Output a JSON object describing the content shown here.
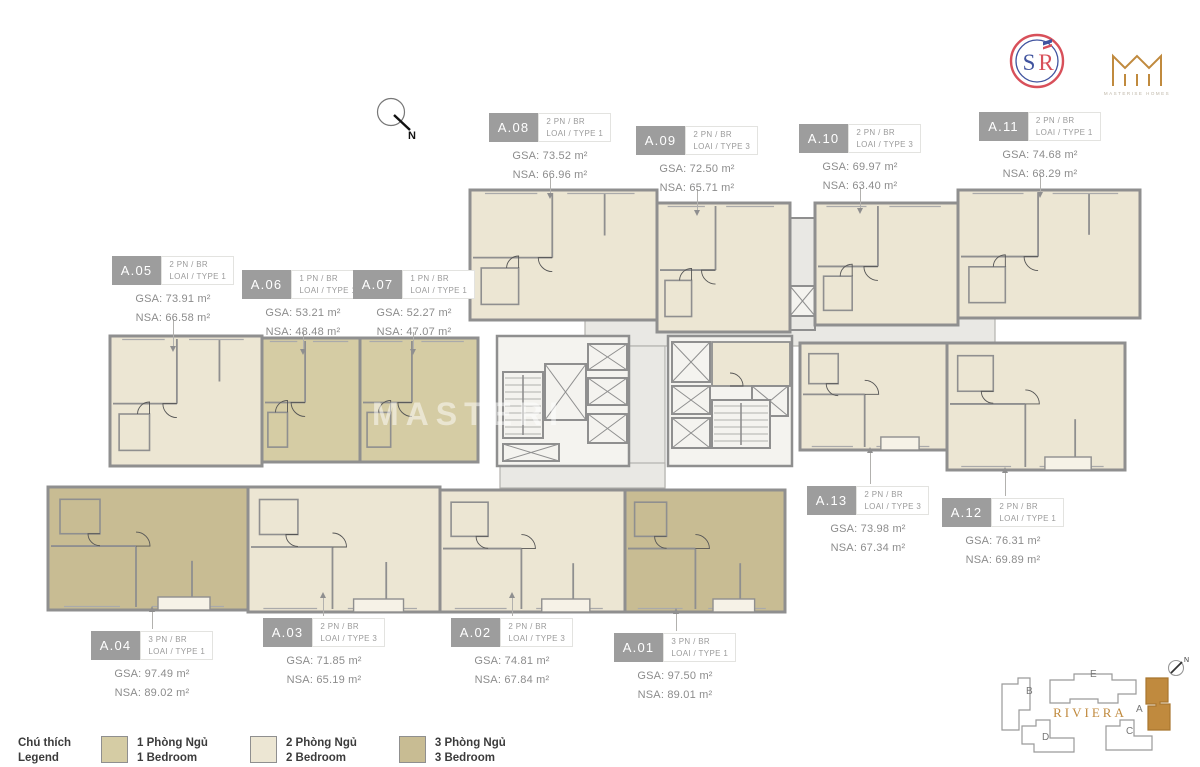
{
  "colors": {
    "bedroom1": "#d5cca4",
    "bedroom2": "#ece6d3",
    "bedroom3": "#c8bc93",
    "wall": "#8f8f8f",
    "wall_light": "#b3b2ae",
    "corridor": "#e9e8e4",
    "core": "#f4f3ef",
    "balcony": "#f6f2e7",
    "badge": "#9d9d9d",
    "label_text": "#8c8c8c",
    "legend_text": "#3c3c3c",
    "accent_gold": "#c08a3e",
    "logo_red": "#d8505a",
    "logo_blue": "#41549f"
  },
  "compass": {
    "label": "N"
  },
  "watermark": {
    "line1": "MASTERI"
  },
  "logos": {
    "sr_s": "S",
    "sr_r": "R",
    "masterise_caption": "MASTERISE HOMES"
  },
  "legend": {
    "title_line1": "Chú thích",
    "title_line2": "Legend",
    "items": [
      {
        "line1": "1 Phòng Ngủ",
        "line2": "1 Bedroom",
        "color_key": "bedroom1"
      },
      {
        "line1": "2 Phòng Ngủ",
        "line2": "2 Bedroom",
        "color_key": "bedroom2"
      },
      {
        "line1": "3 Phòng Ngủ",
        "line2": "3 Bedroom",
        "color_key": "bedroom3"
      }
    ]
  },
  "minimap": {
    "project_name": "RIVIERA",
    "compass_label": "N",
    "highlighted_building": "A",
    "buildings": [
      {
        "label": "A"
      },
      {
        "label": "B"
      },
      {
        "label": "C"
      },
      {
        "label": "D"
      },
      {
        "label": "E"
      }
    ]
  },
  "units": [
    {
      "id": "A.01",
      "type_line1": "3 PN / BR",
      "type_line2": "LOAI / TYPE 1",
      "gsa": "GSA: 97.50 m²",
      "nsa": "NSA: 89.01 m²"
    },
    {
      "id": "A.02",
      "type_line1": "2 PN / BR",
      "type_line2": "LOAI / TYPE 3",
      "gsa": "GSA: 74.81 m²",
      "nsa": "NSA: 67.84 m²"
    },
    {
      "id": "A.03",
      "type_line1": "2 PN / BR",
      "type_line2": "LOAI / TYPE 3",
      "gsa": "GSA: 71.85 m²",
      "nsa": "NSA: 65.19 m²"
    },
    {
      "id": "A.04",
      "type_line1": "3 PN / BR",
      "type_line2": "LOAI / TYPE 1",
      "gsa": "GSA: 97.49 m²",
      "nsa": "NSA: 89.02 m²"
    },
    {
      "id": "A.05",
      "type_line1": "2 PN / BR",
      "type_line2": "LOAI / TYPE 1",
      "gsa": "GSA: 73.91 m²",
      "nsa": "NSA: 66.58 m²"
    },
    {
      "id": "A.06",
      "type_line1": "1 PN / BR",
      "type_line2": "LOAI / TYPE 1",
      "gsa": "GSA: 53.21 m²",
      "nsa": "NSA: 48.48 m²"
    },
    {
      "id": "A.07",
      "type_line1": "1 PN / BR",
      "type_line2": "LOAI / TYPE 1",
      "gsa": "GSA: 52.27 m²",
      "nsa": "NSA: 47.07 m²"
    },
    {
      "id": "A.08",
      "type_line1": "2 PN / BR",
      "type_line2": "LOAI / TYPE 1",
      "gsa": "GSA: 73.52 m²",
      "nsa": "NSA: 66.96 m²"
    },
    {
      "id": "A.09",
      "type_line1": "2 PN / BR",
      "type_line2": "LOAI / TYPE 3",
      "gsa": "GSA: 72.50 m²",
      "nsa": "NSA: 65.71 m²"
    },
    {
      "id": "A.10",
      "type_line1": "2 PN / BR",
      "type_line2": "LOAI / TYPE 3",
      "gsa": "GSA: 69.97 m²",
      "nsa": "NSA: 63.40 m²"
    },
    {
      "id": "A.11",
      "type_line1": "2 PN / BR",
      "type_line2": "LOAI / TYPE 1",
      "gsa": "GSA: 74.68 m²",
      "nsa": "NSA: 68.29 m²"
    },
    {
      "id": "A.12",
      "type_line1": "2 PN / BR",
      "type_line2": "LOAI / TYPE 1",
      "gsa": "GSA: 76.31 m²",
      "nsa": "NSA: 69.89 m²"
    },
    {
      "id": "A.13",
      "type_line1": "2 PN / BR",
      "type_line2": "LOAI / TYPE 3",
      "gsa": "GSA: 73.98 m²",
      "nsa": "NSA: 67.34 m²"
    }
  ]
}
